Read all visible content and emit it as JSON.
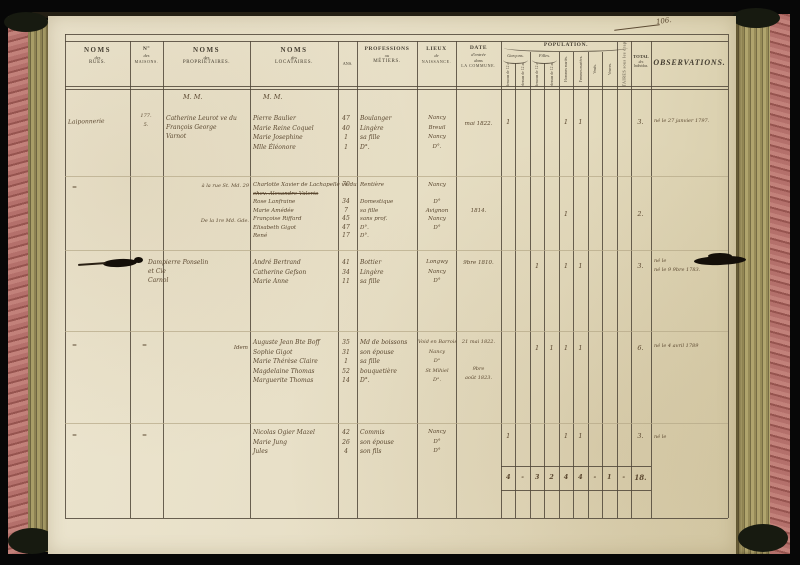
{
  "page_number": "106.",
  "header": {
    "rues": [
      "NOMS",
      "des",
      "RUES."
    ],
    "maisons": [
      "N°",
      "des",
      "MAISONS."
    ],
    "proprietaires": [
      "NOMS",
      "des",
      "PROPRIÉTAIRES."
    ],
    "locataires": [
      "NOMS",
      "des",
      "LOCATAIRES."
    ],
    "age": "ANS.",
    "professions": [
      "PROFESSIONS",
      "ou",
      "MÉTIERS."
    ],
    "lieux": [
      "LIEUX",
      "de",
      "NAISSANCE."
    ],
    "date": [
      "DATE",
      "d'entrée",
      "dans",
      "LA COMMUNE."
    ],
    "population": "POPULATION.",
    "garcons": "Garçons.",
    "filles": "Filles.",
    "pop_subcols": [
      "au-dessous de 12 ans.",
      "au-dessus de 12 ans.",
      "au-dessous de 12 ans.",
      "au-dessus de 12 ans.",
      "Hommes mariés.",
      "Femmes mariées.",
      "Veufs.",
      "Veuves."
    ],
    "militaires": "MILITAIRES sous les drapeaux.",
    "total": [
      "TOTAL",
      "des",
      "Individus."
    ],
    "observations": "OBSERVATIONS.",
    "mm_proprietaires": "M. M.",
    "mm_locataires": "M. M."
  },
  "blocks": [
    {
      "rue": "Laiponnerie",
      "maison": [
        "177.",
        "5."
      ],
      "proprietaire": [
        "Catherine Leurot ve du",
        "François George",
        "Varnot"
      ],
      "locataires": [
        "Pierre Baulier",
        "Marie Reine Coquel",
        "Marie Josephine",
        "Mlle Éléonore"
      ],
      "ages": [
        "47",
        "40",
        "1",
        "1"
      ],
      "professions": [
        "Boulanger",
        "Lingère",
        "sa fille",
        "D°."
      ],
      "lieux": [
        "Nancy",
        "Breuil",
        "Nancy",
        "D°."
      ],
      "date": [
        "mai 1822."
      ],
      "ticks": [
        "1",
        "",
        "",
        "",
        "1",
        "1",
        "",
        "",
        ""
      ],
      "total": "3.",
      "observations": [
        "né le 27 janvier 1797."
      ]
    },
    {
      "rue_note": "=",
      "prop_note1": "à la rue St. Md. 29",
      "prop_note2": "De la 1re Md. Gde.",
      "locataires": [
        "Charlotte Xavier de Lachapelle ve du",
        "chev. Alexandre Valerio",
        "Rose Lanfraine",
        "Marie Amédée",
        "Françoise Riffard",
        "Elisabeth Gigot",
        "René"
      ],
      "ages": [
        "70",
        "",
        "34",
        "7",
        "45",
        "47",
        "17"
      ],
      "professions": [
        "Rentière",
        "",
        "Domestique",
        "sa fille",
        "sans prof.",
        "D°.",
        "D°."
      ],
      "lieux": [
        "Nancy",
        "",
        "D°",
        "Avignon",
        "Nancy",
        "D°"
      ],
      "date": [
        "",
        "",
        "",
        "1814."
      ],
      "ticks": [
        "",
        "",
        "",
        "",
        "1",
        "",
        "",
        "",
        ""
      ],
      "total": "2."
    },
    {
      "proprietaire": [
        "Dampierre Ponselin",
        "et Cie",
        "Carnol"
      ],
      "locataires": [
        "André Bertrand",
        "Catherine Gefson",
        "Marie Anne"
      ],
      "ages": [
        "41",
        "34",
        "11"
      ],
      "professions": [
        "Bottier",
        "Lingère",
        "sa fille"
      ],
      "lieux": [
        "Longwy",
        "Nancy",
        "D°"
      ],
      "date": [
        "9bre 1810."
      ],
      "ticks": [
        "",
        "",
        "1",
        "",
        "1",
        "1",
        "",
        "",
        ""
      ],
      "total": "3.",
      "observations": [
        "né le",
        "né le 9 9bre 1783."
      ]
    },
    {
      "rue_note": "=",
      "maison_note": "=",
      "proprietaire": [
        "Idem"
      ],
      "locataires": [
        "Auguste Jean Bte Boff",
        "Sophie Gigot",
        "Marie Thérèse Claire",
        "Magdelaine Thomas",
        "Marguerite Thomas"
      ],
      "ages": [
        "35",
        "31",
        "1",
        "52",
        "14"
      ],
      "professions": [
        "Md de boissons",
        "son épouse",
        "sa fille",
        "bouquetière",
        "D°."
      ],
      "lieux": [
        "Void en Barrois",
        "Nancy",
        "D°",
        "St Mihiel",
        "D°."
      ],
      "date": [
        "21 mai 1822.",
        "",
        "",
        "9bre",
        "août 1823."
      ],
      "ticks": [
        "",
        "",
        "1",
        "1",
        "1",
        "1",
        "",
        "",
        ""
      ],
      "total": "6.",
      "observations": [
        "né le 4 avril 1789"
      ]
    },
    {
      "rue_note": "=",
      "maison_note": "=",
      "locataires": [
        "Nicolas Ogier Mazel",
        "Marie Jung",
        "Jules"
      ],
      "ages": [
        "42",
        "26",
        "4"
      ],
      "professions": [
        "Commis",
        "son épouse",
        "son fils"
      ],
      "lieux": [
        "Nancy",
        "D°",
        "D°"
      ],
      "ticks": [
        "1",
        "",
        "",
        "",
        "1",
        "1",
        "",
        "",
        ""
      ],
      "total": "3.",
      "observations": [
        "né le"
      ]
    }
  ],
  "totals": {
    "cells": [
      "4",
      "-",
      "3",
      "2",
      "4",
      "4",
      "-",
      "1",
      "-"
    ],
    "total": "18."
  }
}
